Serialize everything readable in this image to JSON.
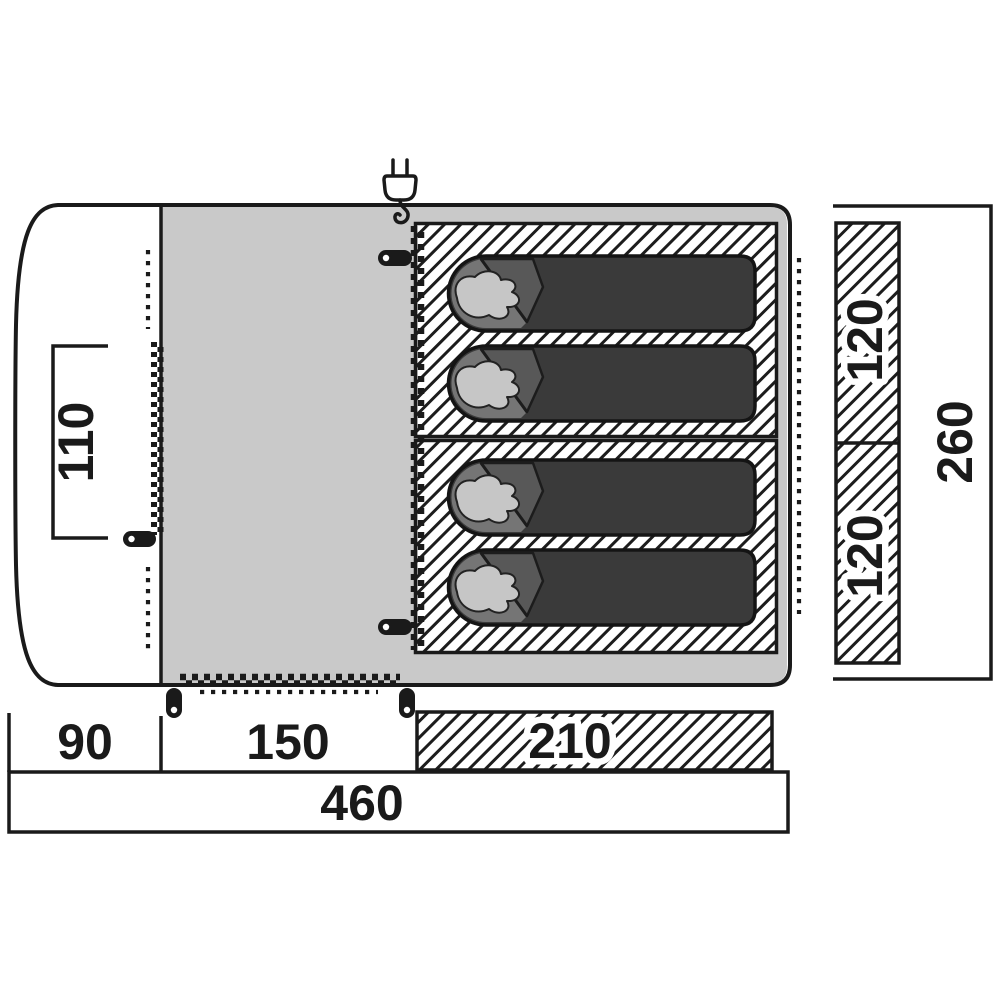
{
  "diagram": {
    "name": "tent-floor-plan",
    "labels": {
      "door_width": "110",
      "sleeping_pod_top_width": "120",
      "sleeping_pod_bottom_width": "120",
      "total_width": "260",
      "front_porch_depth": "90",
      "living_area_depth": "150",
      "sleeping_area_depth": "210",
      "total_length": "460"
    },
    "icons": {
      "power_plug": "power-plug-icon",
      "zipper_pull": "zipper-pull-icon",
      "sleeper": "sleeping-bag-with-pillow-icon"
    },
    "colors": {
      "canvas_bg": "#ffffff",
      "outline": "#1a1a1a",
      "living_area": "#c9c9c9",
      "hatch_line": "#1c1c1c",
      "bag_body": "#3a3a3a",
      "bag_hood": "#757575",
      "bag_flap": "#585858",
      "pillow": "#c6c6c6"
    }
  }
}
